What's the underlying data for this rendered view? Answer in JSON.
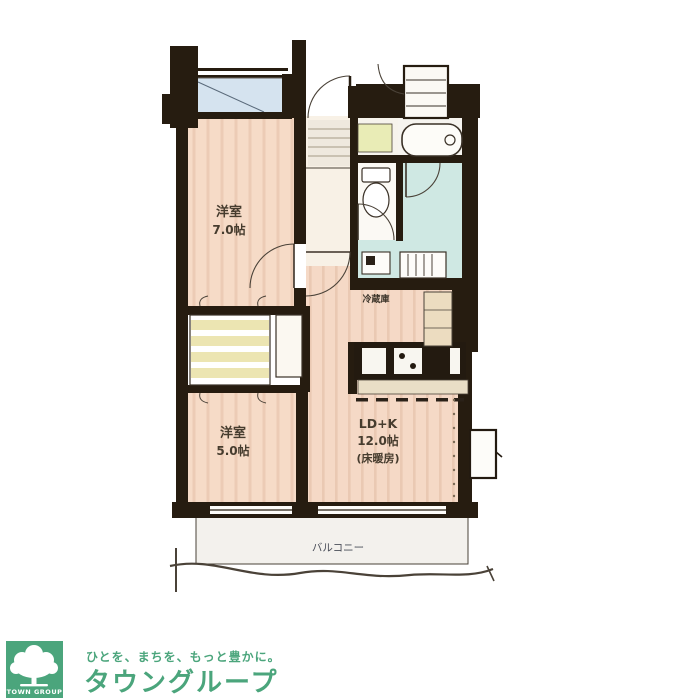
{
  "plan": {
    "rooms": {
      "bedroom1_name": "洋室",
      "bedroom1_size": "7.0帖",
      "bedroom2_name": "洋室",
      "bedroom2_size": "5.0帖",
      "ldk_line1": "LD+K",
      "ldk_line2": "12.0帖",
      "ldk_line3": "(床暖房)",
      "fridge": "冷蔵庫",
      "balcony": "バルコニー"
    },
    "colors": {
      "wall": "#261c10",
      "wood_floor": "#f6dbc7",
      "wet_floor": "#cfe8e3",
      "window_glass": "#d5e3ef",
      "closet_band": "#ece5b2",
      "counter": "#e9dec6"
    }
  },
  "logo": {
    "badge": "TOWN GROUP",
    "tagline": "ひとを、まちを、もっと豊かに。",
    "company": "タウングループ",
    "brand_color": "#4ba57c"
  }
}
